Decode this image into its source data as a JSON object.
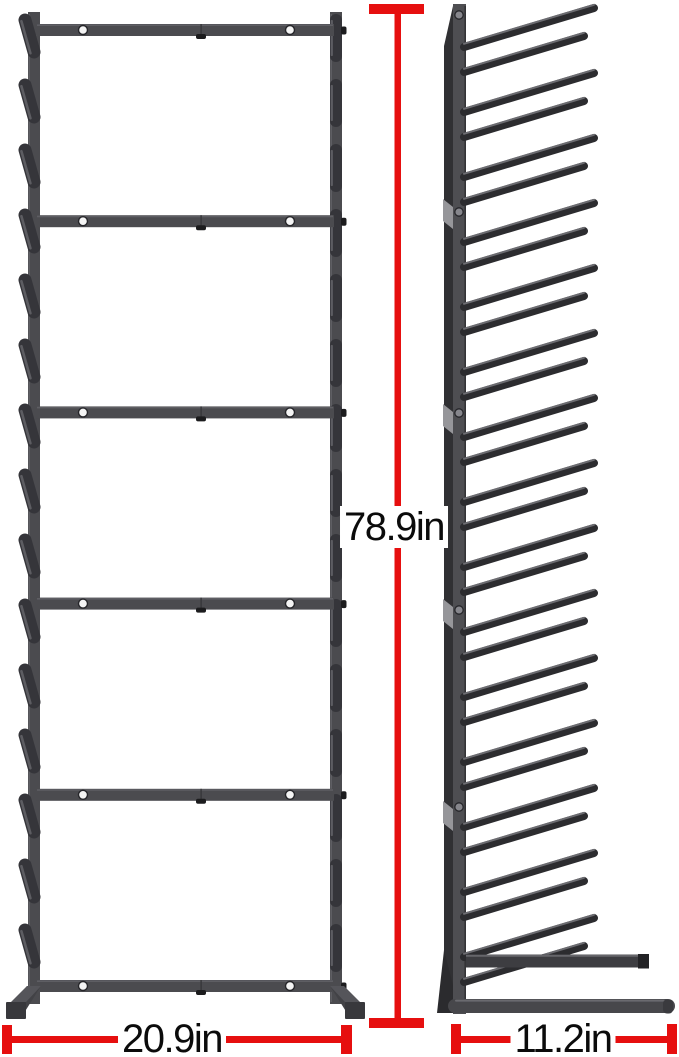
{
  "diagram": {
    "type": "product-dimension-diagram",
    "subject": "vertical storage rack with angled pegs, front and side views",
    "dimensions": {
      "height": {
        "label": "78.9in"
      },
      "width": {
        "label": "20.9in"
      },
      "depth": {
        "label": "11.2in"
      }
    },
    "structure": {
      "crossbar_count": 6,
      "shelf_sections": 5,
      "pegs_per_column": 15,
      "screw_holes_per_bar": 2
    },
    "colors": {
      "dimension_red": "#e60f0f",
      "label_text": "#0b0b0b",
      "rack_frame": "#4b4b4f",
      "rack_peg": "#35353a",
      "peg_highlight": "#5d5d62",
      "side_face": "#303033",
      "joint_clip": "#96969a",
      "screw_hole": "#f4f4f4",
      "background": "#ffffff"
    }
  }
}
